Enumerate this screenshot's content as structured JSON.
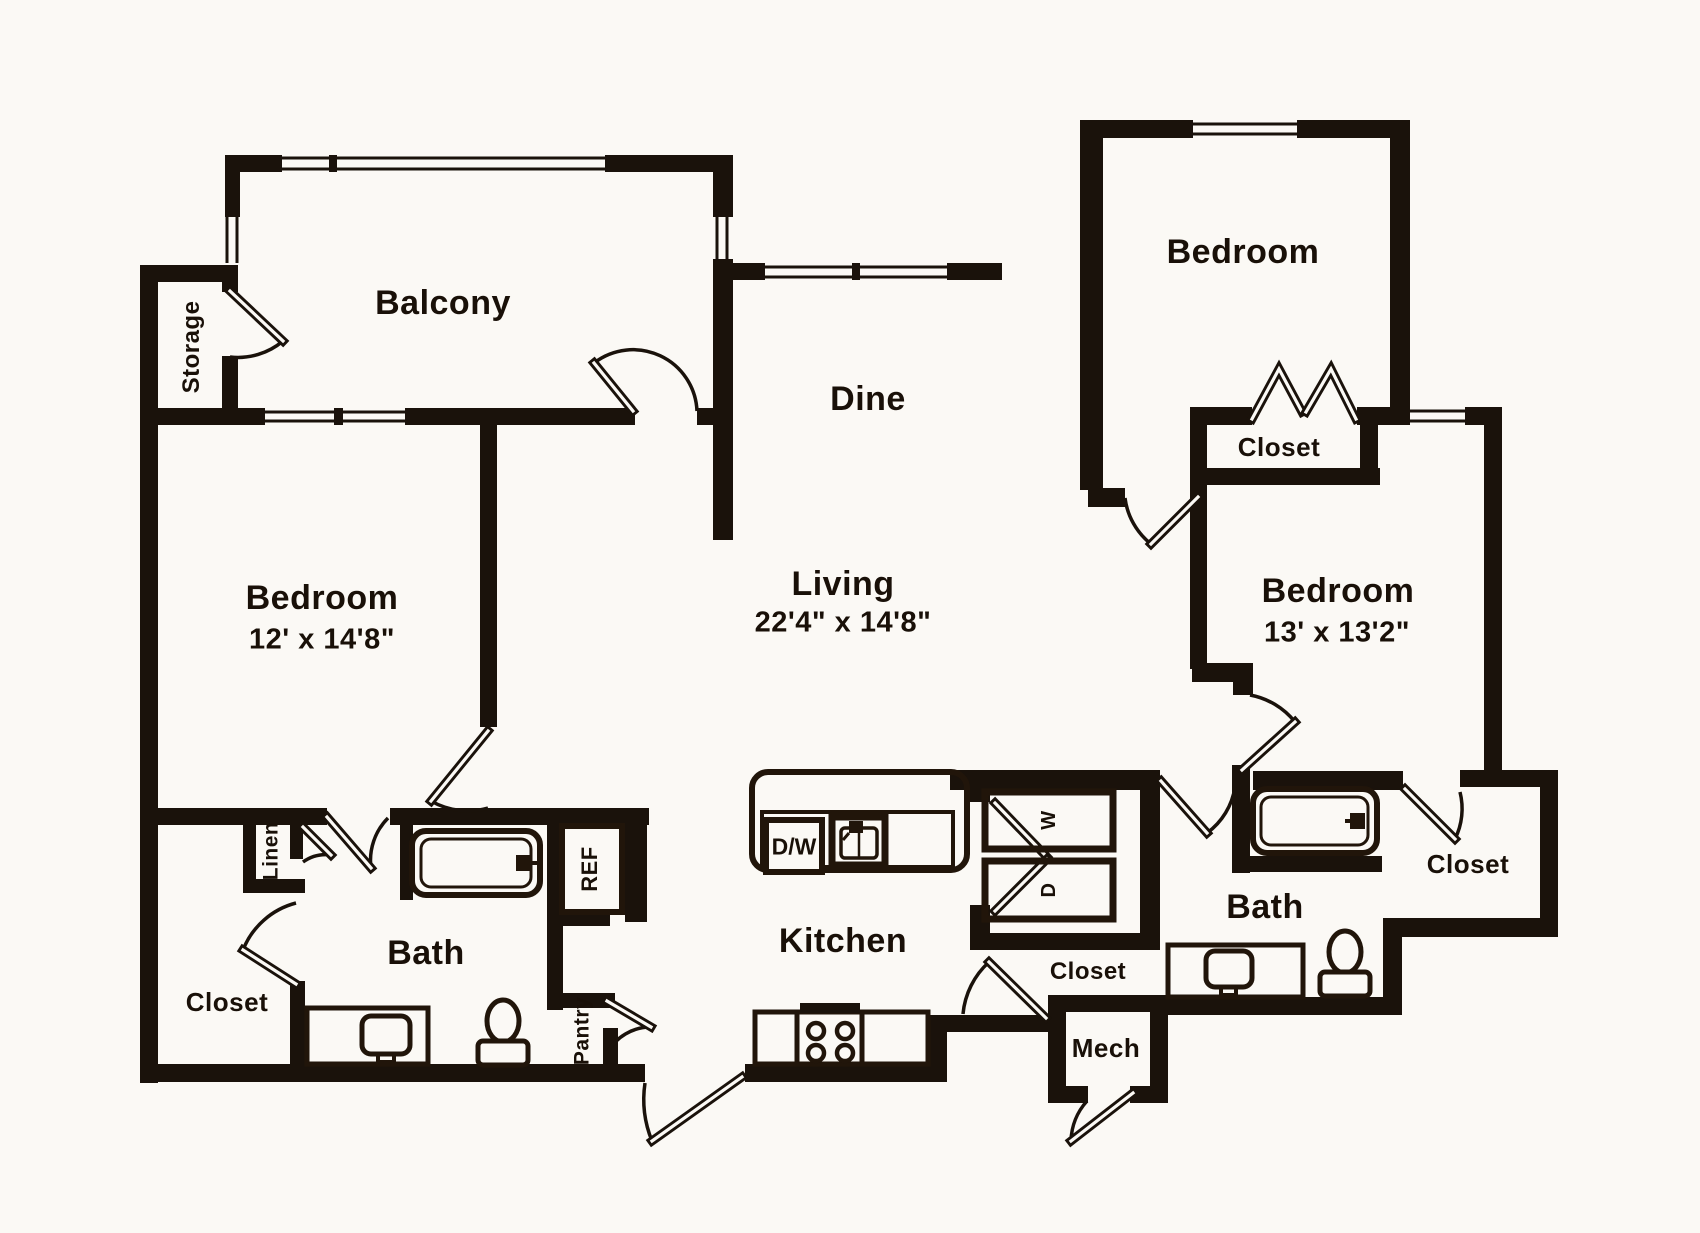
{
  "colors": {
    "wall": "#1a120b",
    "background": "#fbf9f5",
    "fixture_outline": "#21150a"
  },
  "rooms": {
    "balcony": {
      "label": "Balcony"
    },
    "storage": {
      "label": "Storage"
    },
    "bedroom_left": {
      "label": "Bedroom",
      "dims": "12' x 14'8\""
    },
    "dine": {
      "label": "Dine"
    },
    "living": {
      "label": "Living",
      "dims": "22'4\" x 14'8\""
    },
    "bedroom_top_right": {
      "label": "Bedroom"
    },
    "closet_top_right": {
      "label": "Closet"
    },
    "bedroom_right": {
      "label": "Bedroom",
      "dims": "13' x 13'2\""
    },
    "bath_left": {
      "label": "Bath"
    },
    "linen": {
      "label": "Linen"
    },
    "closet_bottom_left": {
      "label": "Closet"
    },
    "pantry": {
      "label": "Pantry"
    },
    "kitchen": {
      "label": "Kitchen"
    },
    "closet_middle": {
      "label": "Closet"
    },
    "mech": {
      "label": "Mech"
    },
    "bath_right": {
      "label": "Bath"
    },
    "closet_right": {
      "label": "Closet"
    }
  },
  "appliances": {
    "dishwasher": "D/W",
    "refrigerator": "REF",
    "washer": "W",
    "dryer": "D"
  }
}
